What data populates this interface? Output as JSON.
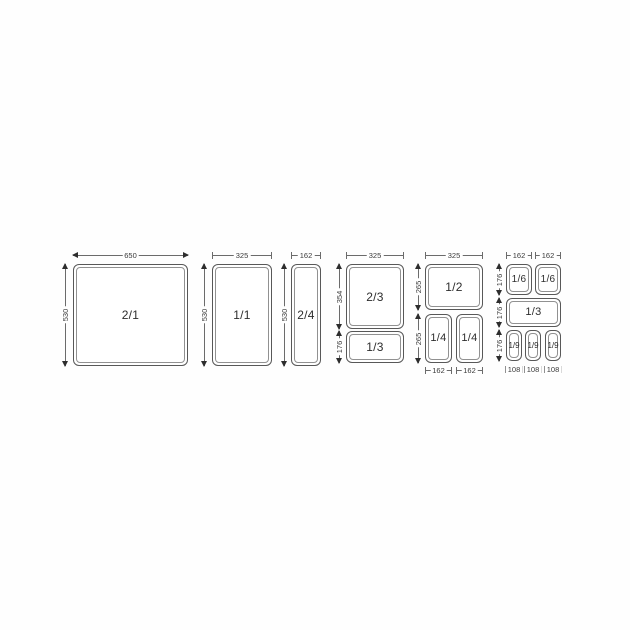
{
  "colors": {
    "background": "#ffffff",
    "line": "#6b6b6b",
    "pan_border": "#585858",
    "pan_inner_border": "#919191",
    "arrow": "#2d2d2d",
    "dimension_text": "#3a3a3a",
    "pan_text": "#2d2d2d"
  },
  "sections": [
    {
      "top_dim": "650",
      "left_dim": "530",
      "pans": [
        {
          "label": "2/1"
        }
      ]
    },
    {
      "top_dim": "325",
      "left_dim": "530",
      "pans": [
        {
          "label": "1/1"
        }
      ]
    },
    {
      "top_dim": "162",
      "left_dim": "530",
      "pans": [
        {
          "label": "2/4"
        }
      ]
    },
    {
      "top_dim": "325",
      "left_dims": [
        "354",
        "176"
      ],
      "pans": [
        {
          "label": "2/3"
        },
        {
          "label": "1/3"
        }
      ]
    },
    {
      "top_dim": "325",
      "left_dims": [
        "265",
        "265"
      ],
      "bottom_dims": [
        "162",
        "162"
      ],
      "pans": [
        {
          "label": "1/2"
        },
        {
          "label": "1/4"
        },
        {
          "label": "1/4"
        }
      ]
    },
    {
      "top_dims": [
        "162",
        "162"
      ],
      "left_dims": [
        "176",
        "176",
        "176"
      ],
      "bottom_dims": [
        "108",
        "108",
        "108"
      ],
      "pans": [
        {
          "label": "1/6"
        },
        {
          "label": "1/6"
        },
        {
          "label": "1/3"
        },
        {
          "label": "1/9"
        },
        {
          "label": "1/9"
        },
        {
          "label": "1/9"
        }
      ]
    }
  ]
}
